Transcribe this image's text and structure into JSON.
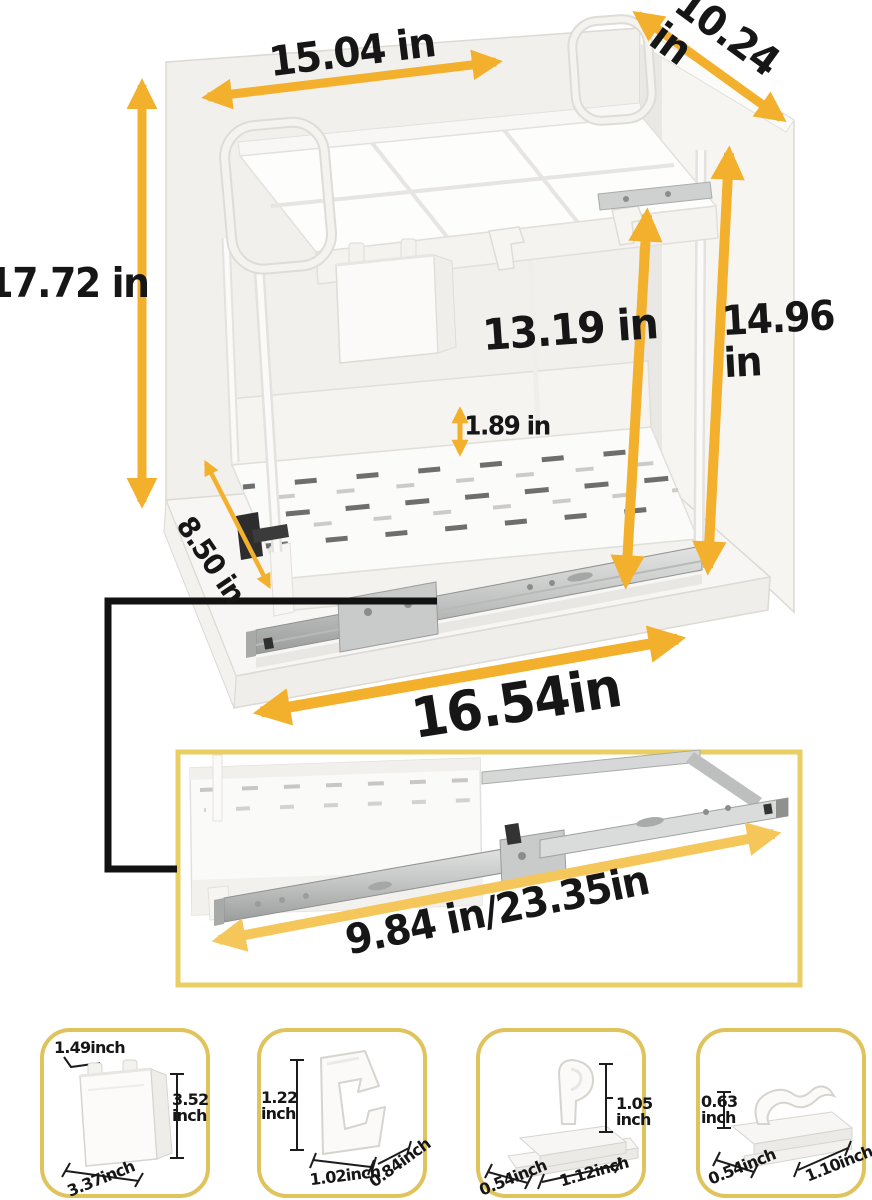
{
  "title": "Pull-out under-sink organizer dimension diagram",
  "colors": {
    "arrow_gold": "#F3B02C",
    "arrow_light": "#F5C65A",
    "outline_black": "#121212",
    "detail_box_border": "#E9CF63",
    "card_border": "#DFC35C",
    "text": "#161616"
  },
  "main_view": {
    "dim_top_width": "15.04 in",
    "dim_top_depth": "10.24 in",
    "dim_overall_height": "17.72 in",
    "dim_inner_height": "13.19 in",
    "dim_side_height": "14.96 in",
    "dim_basket_lip": "1.89 in",
    "dim_base_depth": "8.50 in",
    "dim_base_width": "16.54in"
  },
  "detail_view": {
    "dim_rail_length": "9.84 in/23.35in"
  },
  "accessory_cards": [
    {
      "icon": "hanging-cup",
      "dim_top": "1.49inch",
      "dim_height": "3.52\ninch",
      "dim_width": "3.37inch"
    },
    {
      "icon": "square-hook",
      "dim_height": "1.22\ninch",
      "dim_width": "1.02inch",
      "dim_depth": "0.84inch"
    },
    {
      "icon": "curved-hook",
      "dim_height": "1.05\ninch",
      "dim_depth": "0.54inch",
      "dim_width": "1.12inch"
    },
    {
      "icon": "wave-clip",
      "dim_height": "0.63\ninch",
      "dim_depth": "0.54inch",
      "dim_width": "1.10inch"
    }
  ]
}
